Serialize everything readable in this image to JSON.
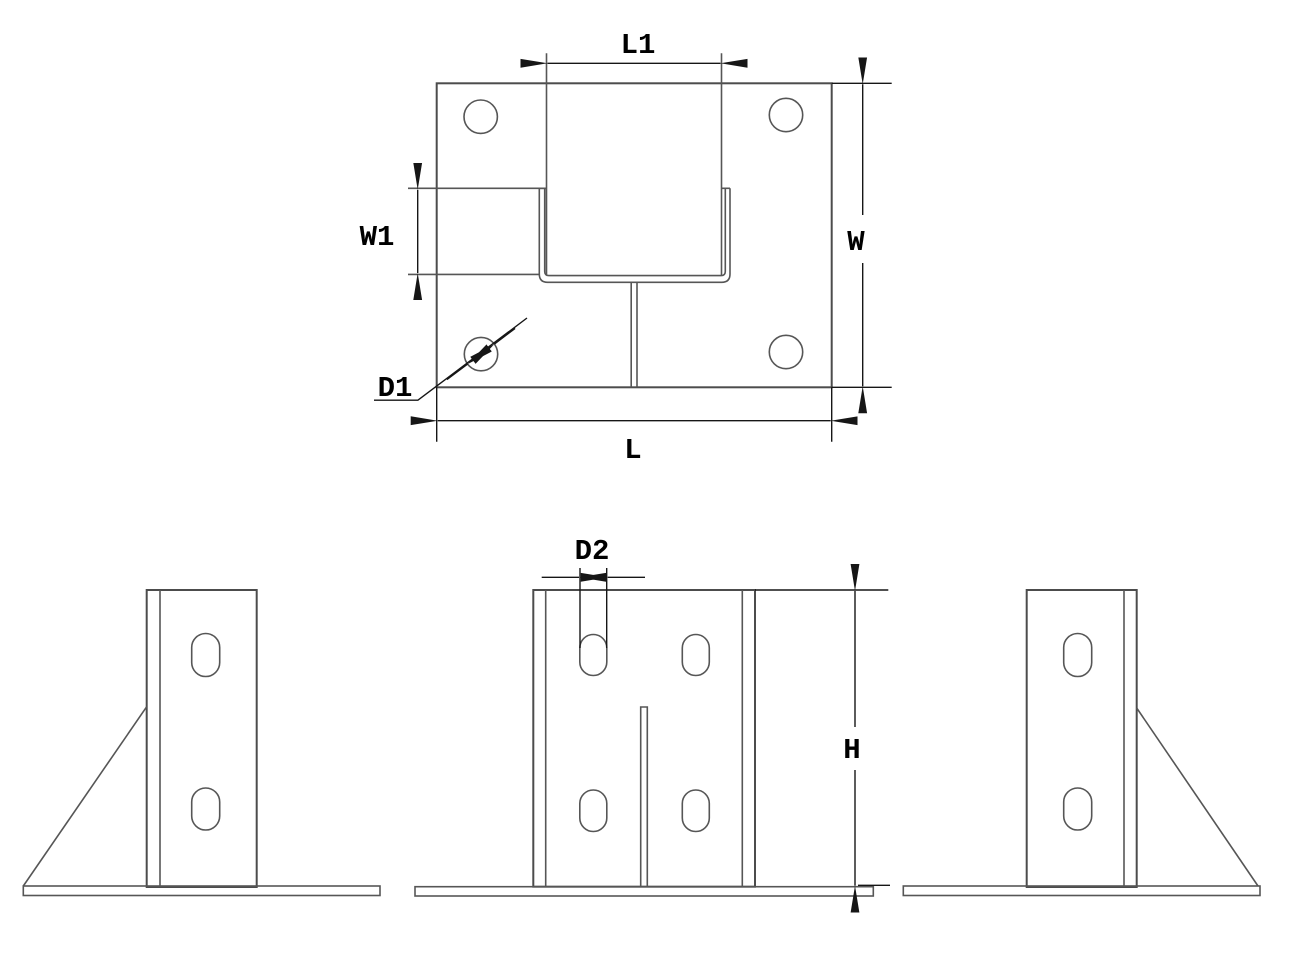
{
  "drawing": {
    "background": "#ffffff",
    "geometry_color": "#4c4c4c",
    "dimension_color": "#161616",
    "text_color": "#000000",
    "labels": {
      "post_length": "L1",
      "tab_width": "W1",
      "plate_width": "W",
      "hole_diameter": "D1",
      "plate_length": "L",
      "slot_width": "D2",
      "height": "H"
    }
  }
}
